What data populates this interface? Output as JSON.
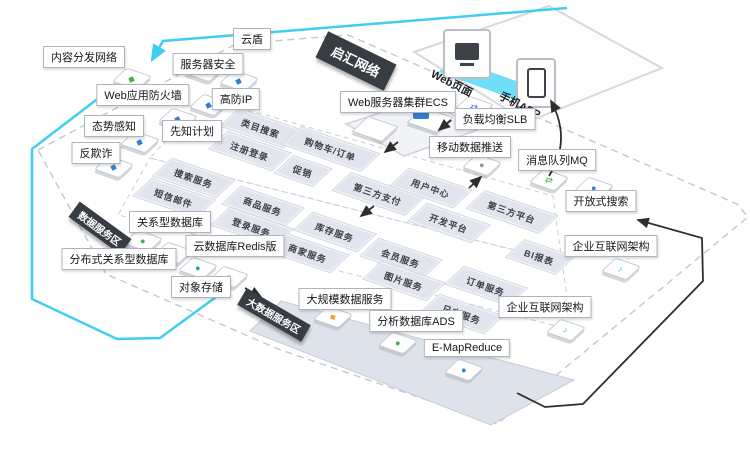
{
  "diagram": {
    "colors": {
      "cyan": "#3fcef2",
      "dark_banner": "#383d44",
      "tile_bg": "#e2e5ee",
      "tile_text": "#3a3e45",
      "black_line": "#2e2e2e",
      "dash_gray": "#c3c7ce",
      "plane_fill": "#dde2eb",
      "blue": "#2f7fd6",
      "green": "#43ad4c",
      "teal": "#2aa98c",
      "orange": "#f0a22e",
      "edas_cyan": "#35c3e8"
    },
    "banners": [
      {
        "id": "qihui-network",
        "text": "启汇网络",
        "x": 356,
        "y": 61,
        "rot": 26,
        "fs": 13,
        "padx": 12,
        "pady": 5
      },
      {
        "id": "data-service-zone",
        "text": "数据服务区",
        "x": 100,
        "y": 228,
        "rot": 36,
        "fs": 10,
        "padx": 7,
        "pady": 2
      },
      {
        "id": "bigdata-service-zone",
        "text": "大数据服务区",
        "x": 274,
        "y": 315,
        "rot": 30,
        "fs": 10,
        "padx": 7,
        "pady": 2
      }
    ],
    "labels": [
      {
        "id": "cdn",
        "text": "内容分发网络",
        "x": 84,
        "y": 57
      },
      {
        "id": "yundun",
        "text": "云盾",
        "x": 252,
        "y": 39
      },
      {
        "id": "server-security",
        "text": "服务器安全",
        "x": 208,
        "y": 64
      },
      {
        "id": "waf",
        "text": "Web应用防火墙",
        "x": 143,
        "y": 95
      },
      {
        "id": "anti-ddos-ip",
        "text": "高防IP",
        "x": 236,
        "y": 99
      },
      {
        "id": "situation-awareness",
        "text": "态势感知",
        "x": 114,
        "y": 126
      },
      {
        "id": "xianzhi-plan",
        "text": "先知计划",
        "x": 192,
        "y": 131
      },
      {
        "id": "anti-fraud",
        "text": "反欺诈",
        "x": 96,
        "y": 153
      },
      {
        "id": "ecs-cluster",
        "text": "Web服务器集群ECS",
        "x": 398,
        "y": 102
      },
      {
        "id": "slb",
        "text": "负载均衡SLB",
        "x": 495,
        "y": 119
      },
      {
        "id": "mobile-push",
        "text": "移动数据推送",
        "x": 470,
        "y": 147
      },
      {
        "id": "mq",
        "text": "消息队列MQ",
        "x": 557,
        "y": 160
      },
      {
        "id": "opensearch",
        "text": "开放式搜索",
        "x": 601,
        "y": 201
      },
      {
        "id": "edas-1",
        "text": "企业互联网架构",
        "x": 611,
        "y": 246
      },
      {
        "id": "edas-2",
        "text": "企业互联网架构",
        "x": 545,
        "y": 307
      },
      {
        "id": "rds",
        "text": "关系型数据库",
        "x": 170,
        "y": 222
      },
      {
        "id": "drds",
        "text": "分布式关系型数据库",
        "x": 119,
        "y": 259
      },
      {
        "id": "redis",
        "text": "云数据库Redis版",
        "x": 235,
        "y": 246
      },
      {
        "id": "oss",
        "text": "对象存储",
        "x": 201,
        "y": 287
      },
      {
        "id": "maxcompute",
        "text": "大规模数据服务",
        "x": 345,
        "y": 299
      },
      {
        "id": "ads",
        "text": "分析数据库ADS",
        "x": 416,
        "y": 321
      },
      {
        "id": "emapreduce",
        "text": "E-MapReduce",
        "x": 467,
        "y": 348
      }
    ],
    "tiles": [
      {
        "id": "category-search",
        "text": "类目搜索",
        "x": 261,
        "y": 128,
        "w": 64
      },
      {
        "id": "register-login",
        "text": "注册登录",
        "x": 250,
        "y": 151,
        "w": 64
      },
      {
        "id": "cart-order",
        "text": "购物车/订单",
        "x": 331,
        "y": 149,
        "w": 80
      },
      {
        "id": "promotion",
        "text": "促销",
        "x": 303,
        "y": 171,
        "w": 38
      },
      {
        "id": "third-party-pay",
        "text": "第三方支付",
        "x": 378,
        "y": 194,
        "w": 74
      },
      {
        "id": "user-center",
        "text": "用户中心",
        "x": 431,
        "y": 188,
        "w": 64
      },
      {
        "id": "third-party-platform",
        "text": "第三方平台",
        "x": 512,
        "y": 212,
        "w": 74
      },
      {
        "id": "dev-platform",
        "text": "开发平台",
        "x": 449,
        "y": 223,
        "w": 64
      },
      {
        "id": "bi-report",
        "text": "BI报表",
        "x": 540,
        "y": 257,
        "w": 50
      },
      {
        "id": "search-service",
        "text": "搜索服务",
        "x": 194,
        "y": 178,
        "w": 64
      },
      {
        "id": "sms-mail",
        "text": "短信邮件",
        "x": 174,
        "y": 198,
        "w": 64
      },
      {
        "id": "product-service",
        "text": "商品服务",
        "x": 263,
        "y": 206,
        "w": 64
      },
      {
        "id": "login-service",
        "text": "登录服务",
        "x": 252,
        "y": 227,
        "w": 64
      },
      {
        "id": "inventory-service",
        "text": "库存服务",
        "x": 335,
        "y": 232,
        "w": 64
      },
      {
        "id": "merchant-service",
        "text": "商家服务",
        "x": 308,
        "y": 253,
        "w": 64
      },
      {
        "id": "member-service",
        "text": "会员服务",
        "x": 401,
        "y": 258,
        "w": 64
      },
      {
        "id": "image-service",
        "text": "图片服务",
        "x": 404,
        "y": 281,
        "w": 64
      },
      {
        "id": "order-service",
        "text": "订单服务",
        "x": 486,
        "y": 286,
        "w": 64
      },
      {
        "id": "log-service",
        "text": "日志服务",
        "x": 462,
        "y": 314,
        "w": 64
      }
    ],
    "device_labels": [
      {
        "id": "web-page",
        "text": "Web页面",
        "x": 452,
        "y": 83
      },
      {
        "id": "mobile-app",
        "text": "手机APP",
        "x": 520,
        "y": 105
      }
    ],
    "icons": [
      {
        "id": "waf-shield-icon",
        "x": 132,
        "y": 79,
        "color": "#44b049",
        "glyph": "◆"
      },
      {
        "id": "cloud-shield-icon",
        "x": 204,
        "y": 71,
        "color": "#2f7fd6",
        "glyph": "◆"
      },
      {
        "id": "server-security-icon",
        "x": 239,
        "y": 81,
        "color": "#2f7fd6",
        "glyph": "◆"
      },
      {
        "id": "anti-ddos-icon",
        "x": 209,
        "y": 105,
        "color": "#2f7fd6",
        "glyph": "◆"
      },
      {
        "id": "xianzhi-icon",
        "x": 178,
        "y": 119,
        "color": "#2f7fd6",
        "glyph": "◆"
      },
      {
        "id": "situation-icon",
        "x": 140,
        "y": 142,
        "color": "#2f7fd6",
        "glyph": "◆"
      },
      {
        "id": "antifraud-icon",
        "x": 114,
        "y": 167,
        "color": "#2f7fd6",
        "glyph": "◆"
      },
      {
        "id": "slb-icon",
        "x": 474,
        "y": 107,
        "color": "#2f7fd6",
        "glyph": "⇄"
      },
      {
        "id": "push-icon",
        "x": 482,
        "y": 165,
        "color": "#8f969e",
        "glyph": "●"
      },
      {
        "id": "mq-icon",
        "x": 549,
        "y": 180,
        "color": "#43ad4c",
        "glyph": "⇄"
      },
      {
        "id": "opensearch-icon",
        "x": 594,
        "y": 188,
        "color": "#2f7fd6",
        "glyph": "●"
      },
      {
        "id": "edas-icon-1",
        "x": 621,
        "y": 269,
        "color": "#35c3e8",
        "glyph": "♪"
      },
      {
        "id": "edas-icon-2",
        "x": 566,
        "y": 330,
        "color": "#35c3e8",
        "glyph": "♪"
      },
      {
        "id": "rds-icon",
        "x": 143,
        "y": 241,
        "color": "#43ad4c",
        "glyph": "●"
      },
      {
        "id": "drds-icon",
        "x": 173,
        "y": 253,
        "color": "#2aa98c",
        "glyph": "●"
      },
      {
        "id": "redis-icon",
        "x": 198,
        "y": 268,
        "color": "#2aa98c",
        "glyph": "●"
      },
      {
        "id": "oss-icon",
        "x": 229,
        "y": 277,
        "color": "#43ad4c",
        "glyph": "●"
      },
      {
        "id": "maxcompute-icon",
        "x": 333,
        "y": 317,
        "color": "#f0a22e",
        "glyph": "■"
      },
      {
        "id": "ads-icon",
        "x": 398,
        "y": 343,
        "color": "#43ad4c",
        "glyph": "●"
      },
      {
        "id": "emr-icon",
        "x": 464,
        "y": 370,
        "color": "#2f7fd6",
        "glyph": "●"
      }
    ]
  }
}
